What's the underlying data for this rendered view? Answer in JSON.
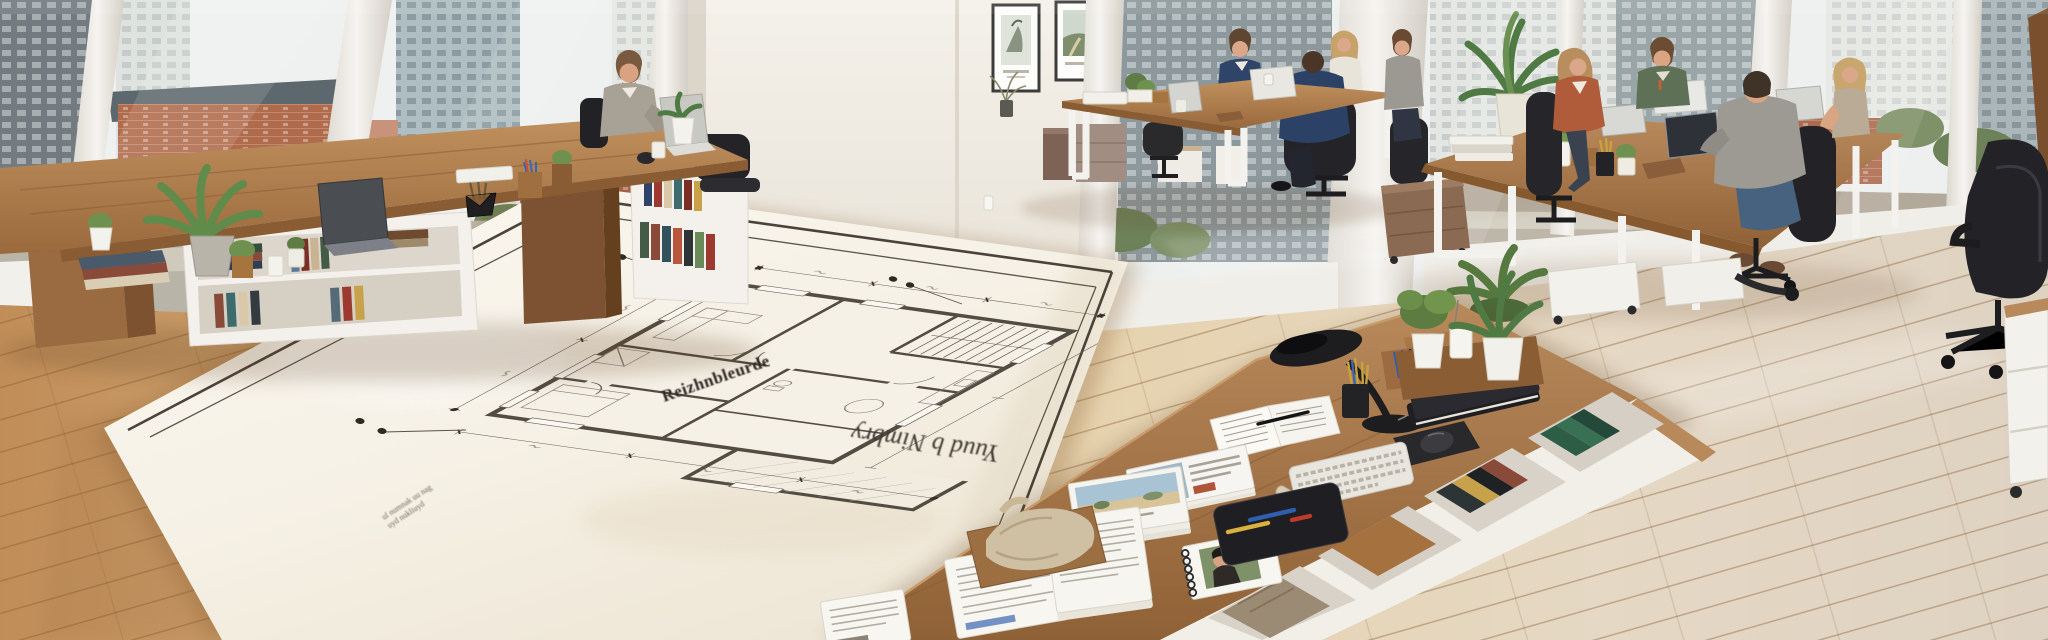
{
  "scene": {
    "description": "Sunlit open-plan architecture studio: a giant residential floor-plan print lies across the oak floor between walnut work islands while colleagues work at laptops in front of floor-to-ceiling city windows.",
    "people_visible": 9,
    "framed_prints_on_wall": 2
  },
  "blueprint": {
    "title_text": "Reizhnbleurde",
    "handwritten_note": "Yuud b Nimbry",
    "scale_note_line1": "ul numnak uu nag",
    "scale_note_line2": "uyd nukliuyd"
  },
  "palette": {
    "walnut_wood": "#a9774a",
    "oak_floor": "#dcc09a",
    "pale_plank": "#e7dccb",
    "shelf_white": "#f4f1ec",
    "blueprint_paper": "#f8f4ec",
    "drafting_ink": "#4a433a",
    "task_chair_black": "#27272a",
    "plant_green": "#5f7c45",
    "navy_knit": "#2e4468",
    "rust_cardigan": "#b05c3a",
    "sage_jacket": "#5e7157",
    "brick_facade": "#ad6a4e",
    "city_glass": "#9fb0b4",
    "lamp_black": "#1d1d1f"
  }
}
